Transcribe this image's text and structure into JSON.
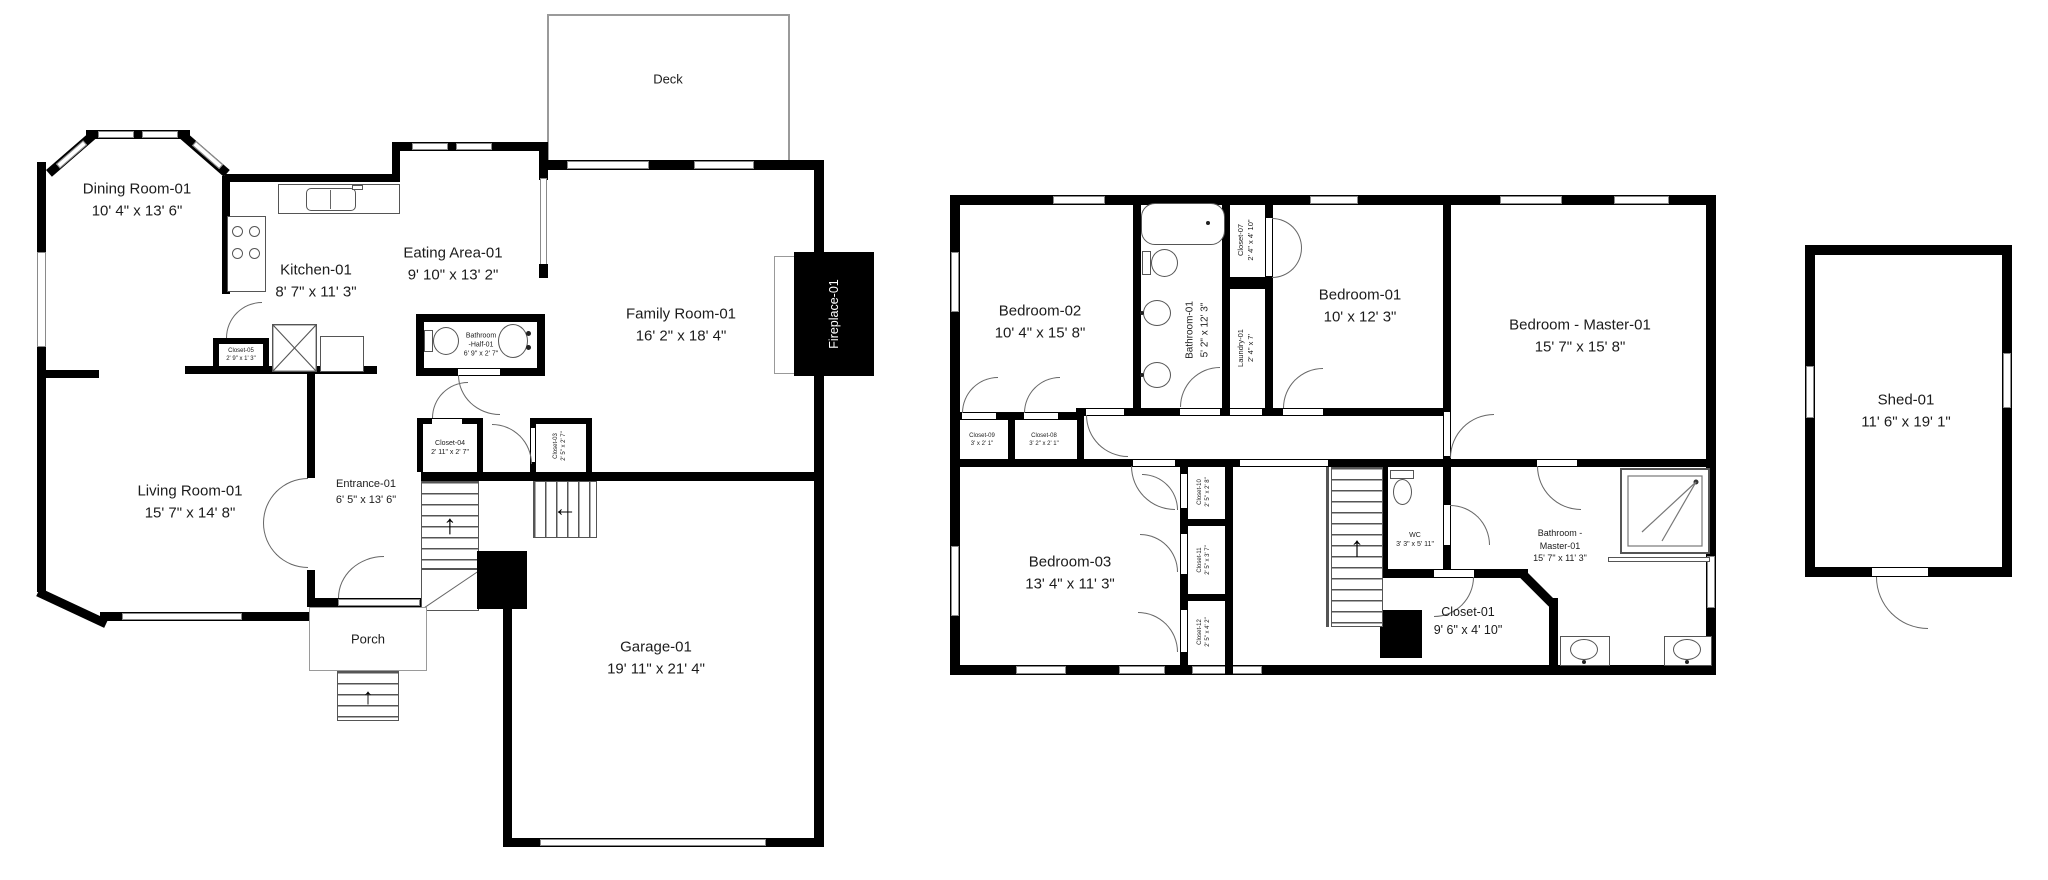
{
  "title": "Two-story house floor plan with shed",
  "colors": {
    "wall": "#000000",
    "background": "#ffffff",
    "fixture_line": "#555555"
  },
  "icons": {
    "stairs_up": "↑",
    "stairs_left": "←"
  },
  "floors": {
    "first": {
      "deck_label": "Deck",
      "porch_label": "Porch",
      "rooms": {
        "dining": {
          "label": "Dining Room-01",
          "dims": "10' 4\" x 13' 6\""
        },
        "kitchen": {
          "label": "Kitchen-01",
          "dims": "8' 7\" x 11' 3\""
        },
        "eating": {
          "label": "Eating Area-01",
          "dims": "9' 10\" x 13' 2\""
        },
        "family": {
          "label": "Family Room-01",
          "dims": "16' 2\" x 18' 4\""
        },
        "living": {
          "label": "Living Room-01",
          "dims": "15' 7\" x 14' 8\""
        },
        "entrance": {
          "label": "Entrance-01",
          "dims": "6' 5\" x 13' 6\""
        },
        "garage": {
          "label": "Garage-01",
          "dims": "19' 11\" x 21' 4\""
        },
        "half_bath": {
          "label_1": "Bathroom",
          "label_2": "-Half-01",
          "dims": "6' 9\" x 2' 7\""
        },
        "closet03": {
          "label": "Closet-03",
          "dims": "2' 5\" x 2' 7\""
        },
        "closet04": {
          "label": "Closet-04",
          "dims": "2' 11\" x 2' 7\""
        },
        "closet05": {
          "label": "Closet-05",
          "dims": "2' 9\" x 1' 3\""
        },
        "fireplace": {
          "label": "Fireplace-01"
        }
      }
    },
    "second": {
      "rooms": {
        "bedroom02": {
          "label": "Bedroom-02",
          "dims": "10' 4\" x 15' 8\""
        },
        "bathroom01": {
          "label": "Bathroom-01",
          "dims": "5' 2\" x 12' 3\""
        },
        "closet07": {
          "label": "Closet-07",
          "dims": "2' 4\" x 4' 10\""
        },
        "laundry": {
          "label": "Laundry-01",
          "dims": "2' 4\" x 7'"
        },
        "bedroom01": {
          "label": "Bedroom-01",
          "dims": "10' x 12' 3\""
        },
        "master": {
          "label": "Bedroom - Master-01",
          "dims": "15' 7\" x 15' 8\""
        },
        "closet09": {
          "label": "Closet-09",
          "dims": "3' x 2' 1\""
        },
        "closet08": {
          "label": "Closet-08",
          "dims": "3' 2\" x 2' 1\""
        },
        "bedroom03": {
          "label": "Bedroom-03",
          "dims": "13' 4\" x 11' 3\""
        },
        "closet10": {
          "label": "Closet-10",
          "dims": "2' 5\" x 2' 8\""
        },
        "closet11": {
          "label": "Closet-11",
          "dims": "2' 5\" x 3' 7\""
        },
        "closet12": {
          "label": "Closet-12",
          "dims": "2' 5\" x 4' 2\""
        },
        "wc": {
          "label": "WC",
          "dims": "3' 3\" x 5' 11\""
        },
        "master_bath": {
          "label_1": "Bathroom -",
          "label_2": "Master-01",
          "dims": "15' 7\" x 11' 3\""
        },
        "closet01": {
          "label": "Closet-01",
          "dims": "9' 6\" x 4' 10\""
        }
      }
    },
    "shed": {
      "rooms": {
        "shed": {
          "label": "Shed-01",
          "dims": "11' 6\" x 19' 1\""
        }
      }
    }
  }
}
